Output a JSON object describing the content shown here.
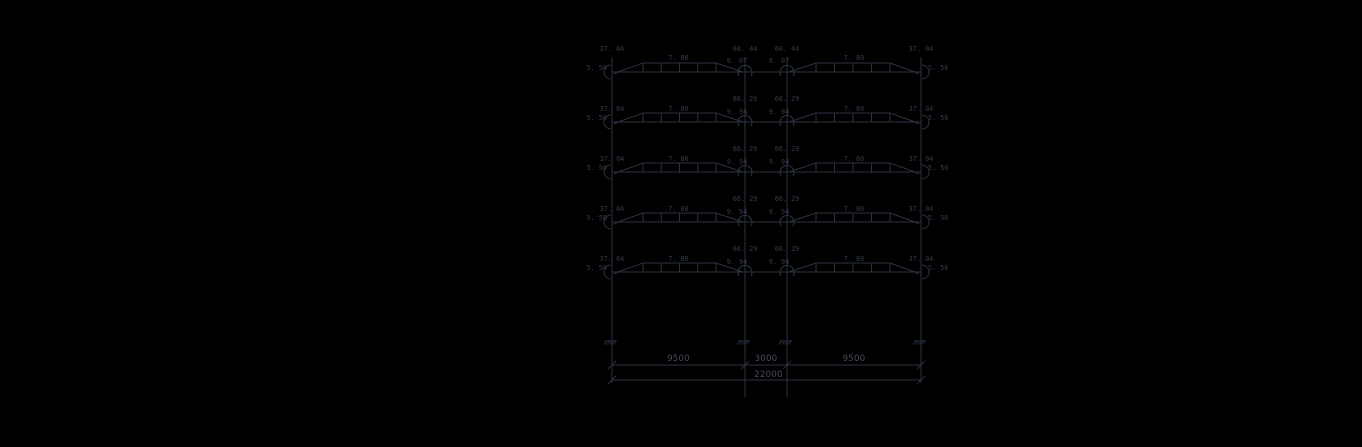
{
  "canvas": {
    "background": "#000000",
    "line_color": "#2b3240",
    "moment_text_color": "#333a4a",
    "dim_text_color": "#454d5e"
  },
  "frame_drawing": {
    "title": "frame-bending-moment-diagram",
    "columns_x": [
      612,
      745,
      787,
      921
    ],
    "beam_levels_y": [
      72,
      122,
      172,
      222,
      272
    ],
    "column_top_y": 57,
    "support_y": 341,
    "diagram_plateau_height": 9,
    "floors": [
      {
        "outer_column_moment": "37. 04",
        "inner_column_moment": "60. 44",
        "beam_midspan_moment": "7. 80",
        "beam_inner_end_moment": "9. 07",
        "beam_outer_end_moment": "5. 56"
      },
      {
        "outer_column_moment": "37. 04",
        "inner_column_moment": "66. 29",
        "beam_midspan_moment": "7. 80",
        "beam_inner_end_moment": "9. 94",
        "beam_outer_end_moment": "5. 56"
      },
      {
        "outer_column_moment": "37. 04",
        "inner_column_moment": "66. 29",
        "beam_midspan_moment": "7. 80",
        "beam_inner_end_moment": "9. 94",
        "beam_outer_end_moment": "5. 56"
      },
      {
        "outer_column_moment": "37. 04",
        "inner_column_moment": "66. 29",
        "beam_midspan_moment": "7. 80",
        "beam_inner_end_moment": "9. 94",
        "beam_outer_end_moment": "5. 56"
      },
      {
        "outer_column_moment": "37. 04",
        "inner_column_moment": "66. 29",
        "beam_midspan_moment": "7. 80",
        "beam_inner_end_moment": "9. 94",
        "beam_outer_end_moment": "5. 56"
      }
    ],
    "dimensions": {
      "span_labels": [
        "9500",
        "3000",
        "9500"
      ],
      "total_label": "22000",
      "line1_y": 365,
      "line2_y": 380,
      "outer_ext_bottom_y": 383,
      "inner_ext_bottom_y": 397
    }
  }
}
